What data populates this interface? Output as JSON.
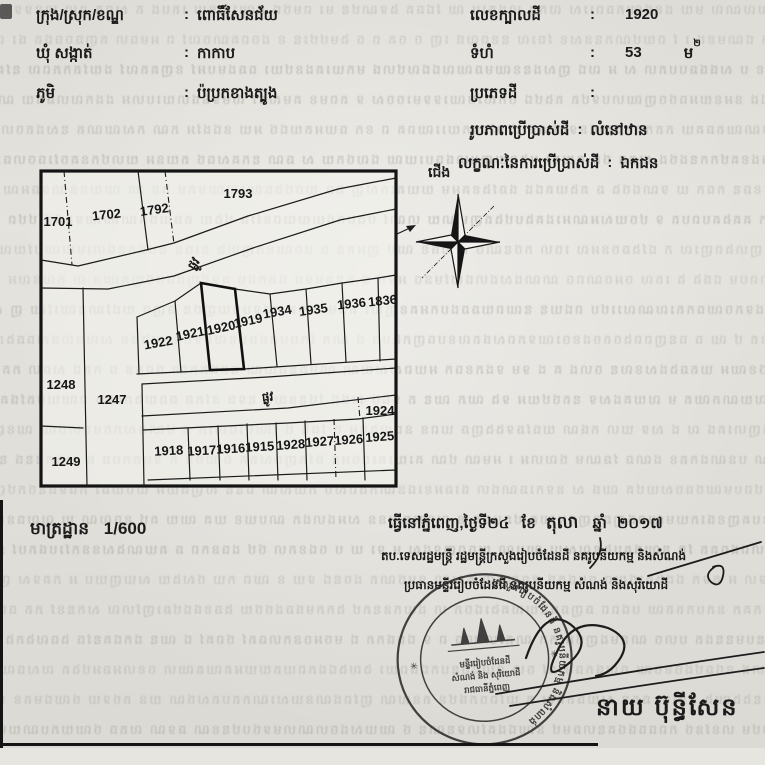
{
  "document": {
    "field_separator": ":",
    "location_fields": [
      {
        "label": "ក្រុង/ស្រុក/ខណ្ឌ",
        "value": "ពោធិ៍សែនជ័យ"
      },
      {
        "label": "ឃុំ សង្កាត់",
        "value": "កាកាប"
      },
      {
        "label": "ភូមិ",
        "value": "ប៉ប្រកខាងត្បូង"
      }
    ],
    "parcel_fields": [
      {
        "label": "លេខក្បាលដី",
        "value": "1920"
      },
      {
        "label": "ទំហំ",
        "value": "53",
        "unit": "ម",
        "unit_sup": "២"
      },
      {
        "label": "ប្រភេទដី",
        "value": ""
      },
      {
        "label": "រូបភាពប្រើប្រាស់ដី",
        "value": "លំនៅឋាន"
      },
      {
        "label": "លក្ខណៈនៃការប្រើប្រាស់ដី",
        "value": "ឯកជន"
      }
    ],
    "compass_north_label": "ជើង",
    "map": {
      "scale_label": "មាត្រដ្ឋាន",
      "scale_value": "1/600",
      "road_label": "ផ្លូវ",
      "subject_parcel": "1920",
      "parcels": {
        "p1701": "1701",
        "p1702": "1702",
        "p1792": "1792",
        "p1793": "1793",
        "p1922": "1922",
        "p1921": "1921",
        "p1920": "1920",
        "p1919": "1919",
        "p1934": "1934",
        "p1935": "1935",
        "p1936": "1936",
        "p1836": "1836",
        "p1248": "1248",
        "p1247": "1247",
        "p1249": "1249",
        "p1924": "1924",
        "p1918": "1918",
        "p1917": "1917",
        "p1916": "1916",
        "p1915": "1915",
        "p1928": "1928",
        "p1927": "1927",
        "p1926": "1926",
        "p1925": "1925"
      }
    },
    "issuance": {
      "date_prefix": "ធ្វើនៅភ្នំពេញ,ថ្ងៃទី២៤",
      "month_label": "ខែ",
      "month_value": "តុលា",
      "year_label": "ឆ្នាំ",
      "year_value": "២០១៧",
      "approval_line1": "តប.ទេសរដ្ឋមន្ត្រី រដ្ឋមន្ត្រីក្រសួងរៀបចំដែនដី នគរូបនីយកម្ម និងសំណង់",
      "approval_line2": "ប្រធានមន្ទីររៀបចំដែនដី នគរូបនីយកម្ម សំណង់ និងសុរិយោដី",
      "signer_name": "នាយ ប៊ុន្ធីសែន",
      "seal": {
        "ring_text": "ក្រសួងរៀបចំដែនដី នគរូបនីយកម្ម និងសំណង់",
        "center_line1": "មន្ទីររៀបចំដែនដី",
        "center_line2": "សំណង់ និង សុរិយោដី",
        "center_line3": "រាជធានីភ្នំពេញ",
        "star_mark": "✳"
      }
    },
    "colors": {
      "ink": "#1b1b1b",
      "paper": "#e7e5df"
    }
  }
}
